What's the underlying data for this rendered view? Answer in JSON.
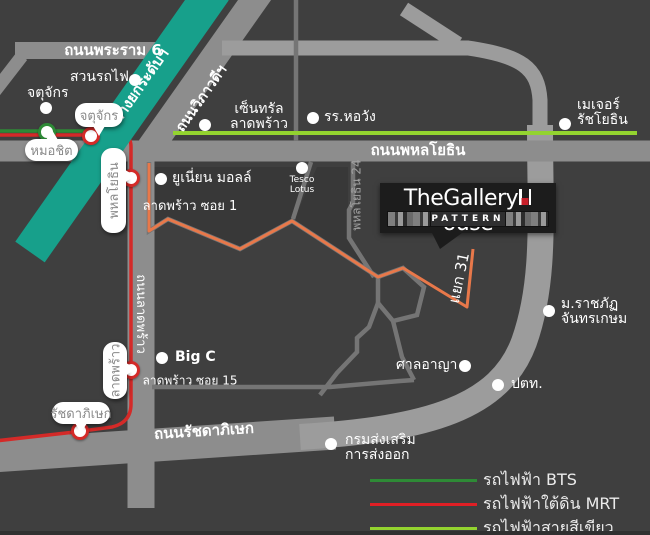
{
  "logo": {
    "title_pre": "TheGallery",
    "title_h": "H",
    "title_post": "ouse",
    "subtitle": "PATTERN"
  },
  "legend": {
    "items": [
      {
        "id": "bts",
        "label": "รถไฟฟ้า BTS",
        "color": "#2e8a36",
        "y": 468
      },
      {
        "id": "mrt",
        "label": "รถไฟฟ้าใต้ดิน MRT",
        "color": "#e01f25",
        "y": 492
      },
      {
        "id": "green-line",
        "label": "รถไฟฟ้าสายสีเขียว",
        "color": "#93d32f",
        "y": 516
      }
    ]
  },
  "road_labels": [
    {
      "id": "road-rama6",
      "text": "ถนนพระราม 6",
      "x": 113,
      "y": 50,
      "size": 15,
      "bold": true,
      "rotate": 0
    },
    {
      "id": "elevated-expressway",
      "text": "ทางยกระดับฯ",
      "x": 140,
      "y": 86,
      "size": 15,
      "bold": true,
      "rotate": -55
    },
    {
      "id": "road-vibhavadi",
      "text": "ถนนวิภาวดีฯ",
      "x": 202,
      "y": 99,
      "size": 14,
      "bold": true,
      "rotate": -55
    },
    {
      "id": "road-phahonyothin",
      "text": "ถนนพหลโยธิน",
      "x": 418,
      "y": 150,
      "size": 15,
      "bold": true,
      "rotate": 0
    },
    {
      "id": "ladprao-soi-1",
      "text": "ลาดพร้าว ซอย 1",
      "x": 190,
      "y": 207,
      "size": 13,
      "bold": false,
      "rotate": 0
    },
    {
      "id": "phahonyothin-24",
      "text": "พหลโยธิน 24",
      "x": 357,
      "y": 195,
      "size": 12,
      "bold": false,
      "rotate": -90,
      "color": "#a0a0a0"
    },
    {
      "id": "yaek-31",
      "text": "แยก 31",
      "x": 459,
      "y": 278,
      "size": 15,
      "bold": false,
      "rotate": -78
    },
    {
      "id": "road-ladprao",
      "text": "ถนนลาดพร้าว",
      "x": 140,
      "y": 314,
      "size": 13,
      "bold": false,
      "rotate": 90
    },
    {
      "id": "ladprao-soi-15",
      "text": "ลาดพร้าว ซอย 15",
      "x": 190,
      "y": 381,
      "size": 12,
      "bold": false,
      "rotate": 0
    },
    {
      "id": "road-ratchadaphisek",
      "text": "ถนนรัชดาภิเษก",
      "x": 204,
      "y": 431,
      "size": 15,
      "bold": true,
      "rotate": -3.5
    }
  ],
  "pois": [
    {
      "id": "suan-rot-fai",
      "lines": [
        "สวนรถไฟ"
      ],
      "dot": {
        "x": 135,
        "y": 80
      },
      "lx": 70,
      "ly": 70,
      "w": 58,
      "align": "right",
      "size": 14
    },
    {
      "id": "chatuchak-park",
      "lines": [
        "จตุจักร"
      ],
      "dot": {
        "x": 46,
        "y": 108
      },
      "lx": 27,
      "ly": 86,
      "w": 46,
      "align": "left",
      "size": 14
    },
    {
      "id": "central-ladprao",
      "lines": [
        "เซ็นทรัล",
        "ลาดพร้าว"
      ],
      "dot": {
        "x": 205,
        "y": 125
      },
      "lx": 228,
      "ly": 102,
      "w": 62,
      "align": "center",
      "size": 14
    },
    {
      "id": "horwang-school",
      "lines": [
        "รร.หอวัง"
      ],
      "dot": {
        "x": 313,
        "y": 118
      },
      "lx": 324,
      "ly": 110,
      "w": 60,
      "align": "left",
      "size": 14
    },
    {
      "id": "major-ratchayothin",
      "lines": [
        "เมเจอร์",
        "รัชโยธิน"
      ],
      "dot": {
        "x": 565,
        "y": 124
      },
      "lx": 577,
      "ly": 98,
      "w": 60,
      "align": "left",
      "size": 14
    },
    {
      "id": "union-mall",
      "lines": [
        "ยูเนี่ยน มอลล์"
      ],
      "dot": {
        "x": 161,
        "y": 179
      },
      "lx": 172,
      "ly": 171,
      "w": 76,
      "align": "left",
      "size": 14
    },
    {
      "id": "tesco-lotus",
      "lines": [
        "Tesco",
        "Lotus"
      ],
      "dot": {
        "x": 302,
        "y": 168
      },
      "lx": 284,
      "ly": 176,
      "w": 36,
      "align": "center",
      "size": 9
    },
    {
      "id": "big-c",
      "lines": [
        "Big C"
      ],
      "dot": {
        "x": 162,
        "y": 358
      },
      "lx": 175,
      "ly": 350,
      "w": 42,
      "align": "left",
      "size": 14,
      "bold": true
    },
    {
      "id": "rajabhat-chandrakasem",
      "lines": [
        "ม.ราชภัฏ",
        "จันทรเกษม"
      ],
      "dot": {
        "x": 549,
        "y": 311
      },
      "lx": 561,
      "ly": 297,
      "w": 72,
      "align": "left",
      "size": 14
    },
    {
      "id": "criminal-court",
      "lines": [
        "ศาลอาญา"
      ],
      "dot": {
        "x": 465,
        "y": 366
      },
      "lx": 396,
      "ly": 358,
      "w": 60,
      "align": "right",
      "size": 14
    },
    {
      "id": "ptt",
      "lines": [
        "ปตท."
      ],
      "dot": {
        "x": 498,
        "y": 385
      },
      "lx": 511,
      "ly": 377,
      "w": 40,
      "align": "left",
      "size": 14
    },
    {
      "id": "export-promotion-dept",
      "lines": [
        "กรมส่งเสริม",
        "การส่งออก"
      ],
      "dot": {
        "x": 331,
        "y": 444
      },
      "lx": 345,
      "ly": 433,
      "w": 84,
      "align": "left",
      "size": 14
    }
  ],
  "stations": [
    {
      "id": "mochit",
      "label": "หมอชิต",
      "type": "bts",
      "ring": "#2e8a36",
      "circle": {
        "x": 47,
        "y": 132
      },
      "box": {
        "x": 25,
        "y": 139,
        "w": 53,
        "h": 22
      },
      "vertical": false,
      "tail": "top"
    },
    {
      "id": "chatuchak",
      "label": "จตุจักร",
      "type": "mrt",
      "ring": "#d42a28",
      "circle": {
        "x": 91,
        "y": 136
      },
      "box": {
        "x": 75,
        "y": 103,
        "w": 48,
        "h": 24
      },
      "vertical": false,
      "tail": "bottom"
    },
    {
      "id": "phahonyothin",
      "label": "พหลโยธิน",
      "type": "mrt",
      "ring": "#d42a28",
      "circle": {
        "x": 131,
        "y": 178
      },
      "box": {
        "x": 101,
        "y": 148,
        "w": 25,
        "h": 85
      },
      "vertical": true,
      "tail": "right",
      "tailTop": 22
    },
    {
      "id": "ladprao",
      "label": "ลาดพร้าว",
      "type": "mrt",
      "ring": "#d42a28",
      "circle": {
        "x": 131,
        "y": 370
      },
      "box": {
        "x": 103,
        "y": 342,
        "w": 24,
        "h": 57
      },
      "vertical": true,
      "tail": "right",
      "tailTop": 21
    },
    {
      "id": "ratchadaphisek",
      "label": "รัชดาภิเษก",
      "type": "mrt",
      "ring": "#d42a28",
      "circle": {
        "x": 80,
        "y": 431
      },
      "box": {
        "x": 52,
        "y": 402,
        "w": 58,
        "h": 22
      },
      "vertical": false,
      "tail": "bottom"
    }
  ],
  "colors": {
    "background": "#3f3f3f",
    "road": "#8d8d8d",
    "road_light": "#9c9c9c",
    "road_thin": "#757575",
    "bts_elevated": "#17a08b",
    "mrt_line": "#d42a28",
    "bts_line": "#2e8a36",
    "green_line": "#93d32f",
    "route_orange": "#e8784a",
    "logo_bg": "#1c1c1c",
    "logo_red": "#c8202b",
    "bubble_text": "#8a8a8a"
  }
}
